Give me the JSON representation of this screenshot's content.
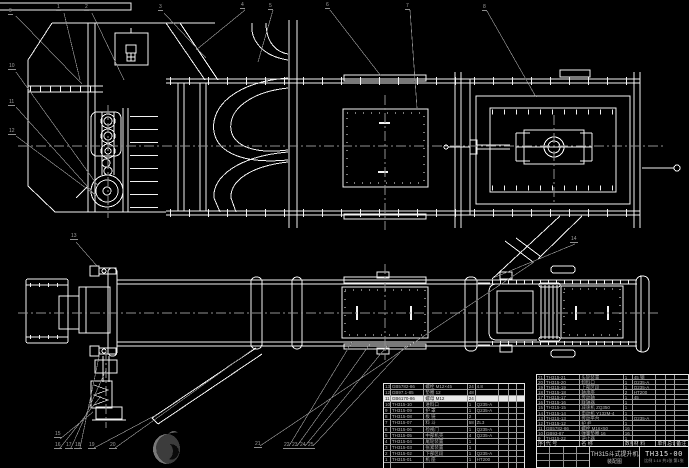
{
  "title_block": {
    "product": "TH315斗式提升机",
    "doc_type": "装配图",
    "drawing_no": "TH315-00",
    "footer_note": "比例 1:10  共1张 第1张"
  },
  "bom": {
    "headers_row": [
      [
        "序号",
        "代 号",
        "名 称",
        "数量",
        "材 料",
        "单件",
        "总计",
        "备注"
      ]
    ],
    "left_rows": [
      [
        "13",
        "GB5782-86",
        "螺栓 M12×45",
        "24",
        "4.8",
        "",
        "",
        ""
      ],
      [
        "12",
        "GB97.1-85",
        "垫圈 12",
        "48",
        "",
        "",
        "",
        ""
      ],
      [
        "11",
        "GB6170-86",
        "螺母 M12",
        "24",
        "",
        "",
        "",
        ""
      ],
      [
        "10",
        "TH315-10",
        "进料口",
        "1",
        "Q235-A",
        "",
        "",
        ""
      ],
      [
        "9",
        "TH315-09",
        "护 罩",
        "1",
        "Q235-A",
        "",
        "",
        ""
      ],
      [
        "8",
        "TH315-08",
        "板 链",
        "2",
        "",
        "",
        "",
        ""
      ],
      [
        "7",
        "TH315-07",
        "料 斗",
        "58",
        "ZL3",
        "",
        "",
        ""
      ],
      [
        "6",
        "TH315-06",
        "检视门",
        "1",
        "Q235-A",
        "",
        "",
        ""
      ],
      [
        "5",
        "TH315-05",
        "中部机壳",
        "4",
        "Q235-A",
        "",
        "",
        ""
      ],
      [
        "4",
        "TH315-04",
        "尾轮装置",
        "1",
        "",
        "",
        "",
        ""
      ],
      [
        "3",
        "TH315-03",
        "张紧装置",
        "1",
        "",
        "",
        "",
        ""
      ],
      [
        "2",
        "TH315-02",
        "下部区段",
        "1",
        "Q235-A",
        "",
        "",
        ""
      ],
      [
        "1",
        "TH315-01",
        "机 座",
        "1",
        "HT200",
        "",
        "",
        ""
      ],
      [
        "",
        "",
        "",
        "",
        "",
        "",
        "",
        ""
      ]
    ],
    "right_rows": [
      [
        "21",
        "TH315-21",
        "头轮装置",
        "1",
        "45 钢",
        "",
        "",
        ""
      ],
      [
        "20",
        "TH315-20",
        "卸料口",
        "1",
        "Q235-A",
        "",
        "",
        ""
      ],
      [
        "19",
        "TH315-19",
        "上部区段",
        "1",
        "Q235-A",
        "",
        "",
        ""
      ],
      [
        "18",
        "TH315-18",
        "轴承座",
        "2",
        "HT200",
        "",
        "",
        ""
      ],
      [
        "17",
        "TH315-17",
        "传动轴",
        "1",
        "45",
        "",
        "",
        ""
      ],
      [
        "16",
        "TH315-16",
        "联轴器",
        "1",
        "",
        "",
        "",
        ""
      ],
      [
        "15",
        "TH315-15",
        "减速机 ZQ350",
        "1",
        "",
        "",
        "",
        ""
      ],
      [
        "14",
        "TH315-14",
        "电动机 Y132M-4",
        "1",
        "",
        "",
        "",
        ""
      ],
      [
        "13",
        "TH315-13",
        "传动平台",
        "1",
        "Q235-A",
        "",
        "",
        ""
      ],
      [
        "12",
        "TH315-12",
        "护 栏",
        "1",
        "",
        "",
        "",
        ""
      ],
      [
        "11",
        "GB5782-86",
        "螺栓 M16×50",
        "16",
        "",
        "",
        "",
        ""
      ],
      [
        "10",
        "GB93-87",
        "弹簧垫圈 16",
        "16",
        "",
        "",
        "",
        ""
      ],
      [
        "9",
        "TH315-22",
        "逆止器",
        "1",
        "",
        "",
        "",
        ""
      ]
    ]
  },
  "balloons": {
    "all": [
      {
        "n": "1",
        "x": 56,
        "y": 5
      },
      {
        "n": "2",
        "x": 84,
        "y": 5
      },
      {
        "n": "3",
        "x": 158,
        "y": 5
      },
      {
        "n": "4",
        "x": 240,
        "y": 3
      },
      {
        "n": "5",
        "x": 268,
        "y": 4
      },
      {
        "n": "6",
        "x": 325,
        "y": 3
      },
      {
        "n": "7",
        "x": 405,
        "y": 4
      },
      {
        "n": "8",
        "x": 482,
        "y": 5
      },
      {
        "n": "9",
        "x": 8,
        "y": 9
      },
      {
        "n": "10",
        "x": 8,
        "y": 64
      },
      {
        "n": "11",
        "x": 8,
        "y": 100
      },
      {
        "n": "12",
        "x": 8,
        "y": 129
      },
      {
        "n": "13",
        "x": 70,
        "y": 234
      },
      {
        "n": "14",
        "x": 570,
        "y": 237
      },
      {
        "n": "15",
        "x": 54,
        "y": 432
      },
      {
        "n": "16",
        "x": 54,
        "y": 443
      },
      {
        "n": "17",
        "x": 65,
        "y": 443
      },
      {
        "n": "18",
        "x": 74,
        "y": 443
      },
      {
        "n": "19",
        "x": 88,
        "y": 443
      },
      {
        "n": "20",
        "x": 109,
        "y": 443
      },
      {
        "n": "21",
        "x": 254,
        "y": 442
      },
      {
        "n": "22",
        "x": 283,
        "y": 443
      },
      {
        "n": "23",
        "x": 291,
        "y": 443
      },
      {
        "n": "24",
        "x": 299,
        "y": 443
      },
      {
        "n": "25",
        "x": 307,
        "y": 443
      }
    ]
  },
  "colors": {
    "background": "#000000",
    "line": "#f2f2f2",
    "dim": "#9a9a9a",
    "highlight_row": "#e9e9e9"
  }
}
